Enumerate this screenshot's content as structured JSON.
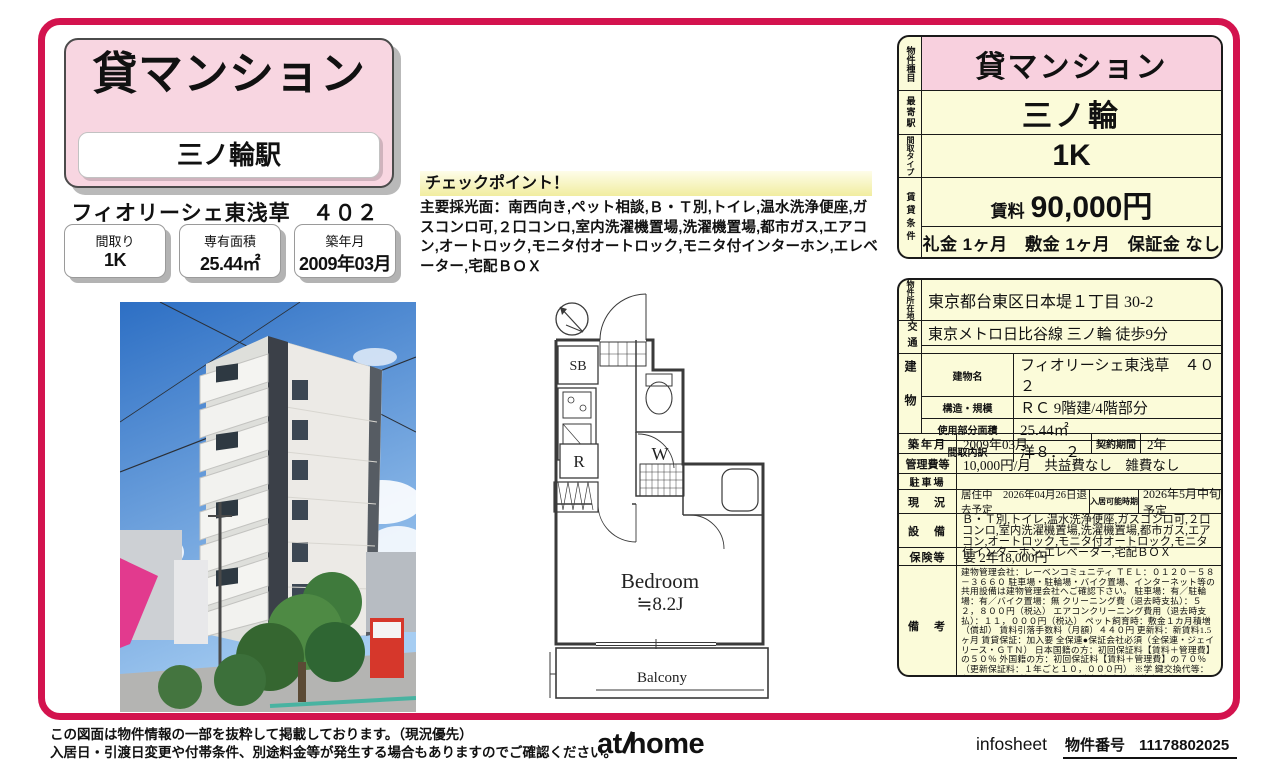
{
  "header": {
    "property_type": "貸マンション",
    "station": "三ノ輪駅",
    "property_name": "フィオリーシェ東浅草　４０２"
  },
  "badges": [
    {
      "label": "間取り",
      "value": "1K"
    },
    {
      "label": "専有面積",
      "value": "25.44㎡"
    },
    {
      "label": "築年月",
      "value": "2009年03月"
    }
  ],
  "checkpoint": {
    "title": "チェックポイント！",
    "body": "主要採光面：南西向き,ペット相談,Ｂ・Ｔ別,トイレ,温水洗浄便座,ガスコンロ可,２口コンロ,室内洗濯機置場,洗濯機置場,都市ガス,エアコン,オートロック,モニタ付オートロック,モニタ付インターホン,エレベーター,宅配ＢＯＸ"
  },
  "floorplan": {
    "sb": "SB",
    "r": "R",
    "w": "W",
    "bedroom": "Bedroom",
    "bedroom_size": "≒8.2J",
    "balcony": "Balcony"
  },
  "summary": {
    "type_label": "物件種目",
    "type_value": "貸マンション",
    "station_label": "最寄駅",
    "station_value": "三ノ輪",
    "layout_label": "間取タイプ",
    "layout_value": "1K",
    "rental_label": "賃貸条件",
    "rent_label": "賃料",
    "rent_value": "90,000円",
    "terms": "礼金 1ヶ月　敷金 1ヶ月　保証金 なし"
  },
  "details": {
    "location": {
      "label": "物件所在地",
      "value": "東京都台東区日本堤１丁目 30-2"
    },
    "access": {
      "label": "交通",
      "line1": "東京メトロ日比谷線 三ノ輪 徒歩9分",
      "line2": ""
    },
    "building": {
      "label": "建物",
      "rows": [
        {
          "k": "建物名",
          "v": "フィオリーシェ東浅草　４０２"
        },
        {
          "k": "構造・規模",
          "v": "ＲＣ 9階建/4階部分"
        },
        {
          "k": "使用部分面積",
          "v": "25.44㎡"
        },
        {
          "k": "間取内訳",
          "v": "洋８．２"
        }
      ]
    },
    "built": {
      "label": "築年月",
      "value": "2009年03月",
      "label2": "契約期間",
      "value2": "2年"
    },
    "fees": {
      "label": "管理費等",
      "value": "10,000円/月　共益費なし　雑費なし"
    },
    "parking": {
      "label": "駐車場",
      "value": ""
    },
    "status": {
      "label": "現　況",
      "value": "居住中　2026年04月26日退去予定",
      "label2": "入居可能時期",
      "value2": "2026年5月中旬予定"
    },
    "equipment": {
      "label": "設　備",
      "value": "Ｂ・Ｔ別,トイレ,温水洗浄便座,ガスコンロ可,２口コンロ,室内洗濯機置場,洗濯機置場,都市ガス,エアコン,オートロック,モニタ付オートロック,モニタ付インターホン,エレベーター,宅配ＢＯＸ"
    },
    "insurance": {
      "label": "保険等",
      "value": "要 2年18,000円"
    },
    "remarks": {
      "label": "備　考",
      "value": "建物管理会社：レーベンコミュニティ ＴＥＬ：０１２０－５８－３６６０ 駐車場・駐輪場・バイク置場、インターネット等の共用設備は建物管理会社へご確認下さい。 駐車場：有／駐輪場：有／バイク置場：無 クリーニング費（退去時支払）：５２，８００円（税込） エアコンクリーニング費用（退去時支払）：１１，０００円（税込） ペット飼育時：敷金１カ月積増（償却） 賃料引落手数料（月額）４４０円 更新料：新賃料1.5ヶ月 賃貸保証：加入要 全保連●保証会社必須（全保連・ジェイリース・ＧＴＮ） 日本国籍の方：初回保証料【賃料＋管理費】の５０％ 外国籍の方：初回保証料【賃料＋管理費】の７０％（更新保証料：１年ごと１０，０００円） ※学 鍵交換代等：有 22,000円～ 利用駅１：ＪＲ常磐線 南千住 徒歩11分"
    }
  },
  "footer": {
    "note1": "この図面は物件情報の一部を抜粋して掲載しております。（現況優先）",
    "note2": "入居日・引渡日変更や付帯条件、別途料金等が発生する場合もありますのでご確認ください。",
    "logo_at": "at",
    "logo_home": "home",
    "infosheet": "infosheet",
    "property_no_label": "物件番号",
    "property_no": "11178802025"
  },
  "colors": {
    "accent": "#d3134e",
    "pink": "#f8d6e1",
    "cream": "#fbfbd9"
  }
}
